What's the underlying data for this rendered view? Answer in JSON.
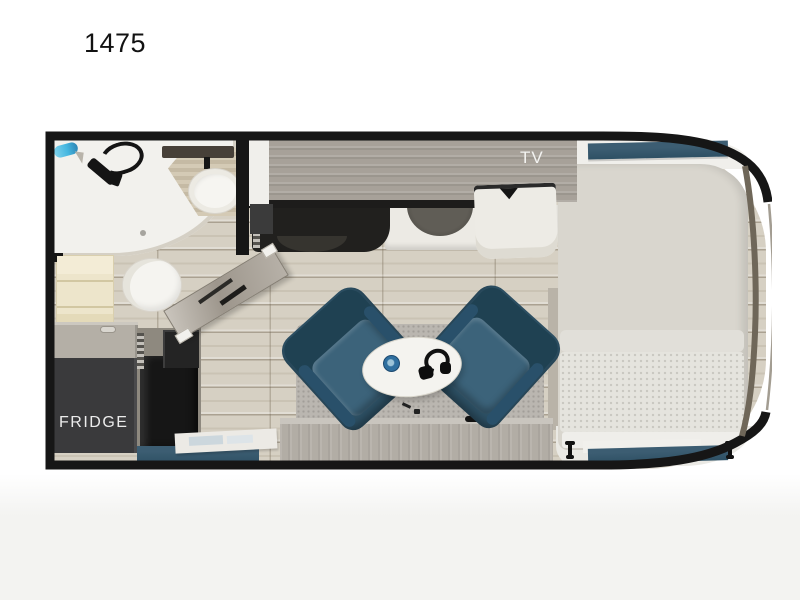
{
  "title": "1475",
  "plan": {
    "labels": {
      "tv": "TV",
      "fridge": "FRIDGE"
    },
    "colors": {
      "wall": "#161616",
      "tile": "#d6d0c3",
      "teal": "#2e5064",
      "chair": "#2d5064",
      "cabinet": "#a7a199",
      "counter-white": "#eceae4",
      "fridge-box": "#3a3a3c",
      "mattress": "#d9d6ce",
      "blanket": "#e5e4de",
      "rug": "#bab6b0",
      "cream": "#ede5cb",
      "table": "#f4f3ef",
      "faucet-blue": "#45b7e0",
      "cap-line": "#6f6759",
      "appliance-black": "#161616"
    },
    "features": [
      "shower",
      "showerhead",
      "shower-faucet",
      "vanity",
      "bathroom-sink",
      "mirror-shelf",
      "toilet",
      "linen-shelves",
      "overhead-cabinet-with-tv",
      "cooktop-recess",
      "kitchen-sink",
      "counter",
      "nightstand",
      "fridge",
      "range-oven",
      "microwave",
      "entry-door-open",
      "step-bench",
      "lounge-chair-left",
      "lounge-chair-right",
      "cocktail-table",
      "headset",
      "mug",
      "rug",
      "rear-wardrobe",
      "bed",
      "head-window-strip",
      "foot-window-strip",
      "tie-down-left",
      "tie-down-right"
    ]
  }
}
